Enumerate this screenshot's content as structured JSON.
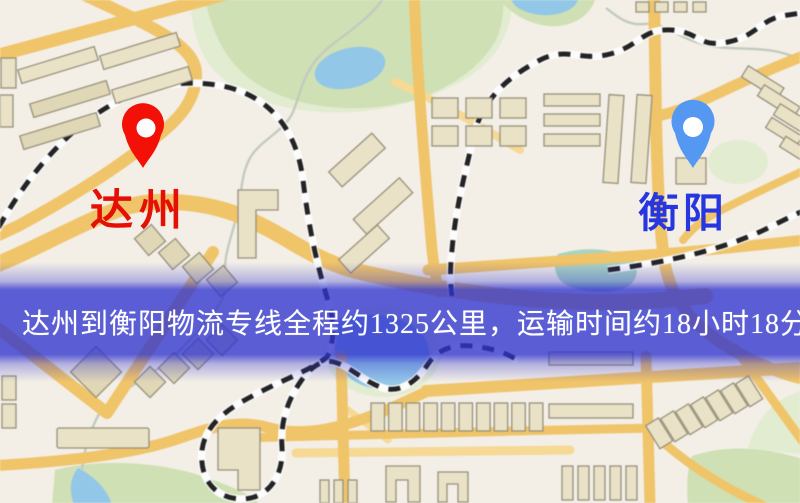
{
  "page": {
    "width": 800,
    "height": 503,
    "description": "logistics route map"
  },
  "banner": {
    "text": "达州到衡阳物流专线全程约1325公里，运输时间约18小时18分钟.",
    "background": "#3034cd",
    "text_color": "#ffffff"
  },
  "route": {
    "origin": "达州",
    "destination": "衡阳",
    "distance": "约1325公里",
    "duration": "约18小时18分钟"
  },
  "markers": {
    "origin": {
      "label": "达州",
      "pin_color": "#f21007",
      "label_color": "#e50f05"
    },
    "destination": {
      "label": "衡阳",
      "pin_color": "#5598f2",
      "label_color": "#2636e0"
    }
  },
  "theme": {
    "bg": "#f3efe7",
    "park": "#cfe0b4",
    "parkpale": "#e2ecd0",
    "water": "#93c7e8",
    "road": "#f0c469",
    "roadminor": "#f5d994",
    "rail": "#232323",
    "railcase": "#fcfcfc",
    "bldg": "#e9e2c6",
    "bldgline": "#97907b",
    "pin-origin": "#f21007",
    "pin-dest": "#5598f2",
    "label-origin": "#e50f05",
    "label-dest": "#2636e0",
    "banner-text": "#ffffff"
  }
}
